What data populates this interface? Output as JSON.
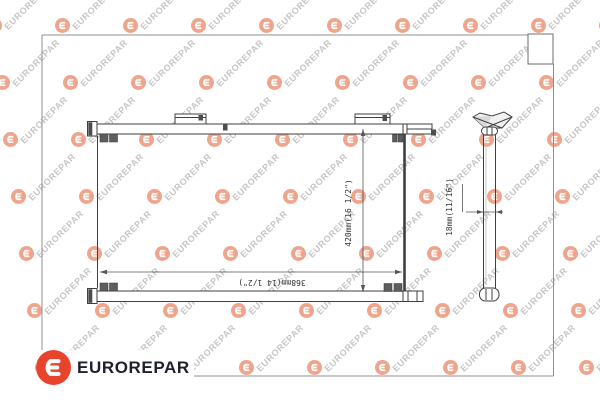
{
  "brand": {
    "name": "EUROREPAR",
    "logo_color": "#e8432c",
    "text_color": "#1e2030"
  },
  "watermark": {
    "text": "EUROREPAR",
    "text_color": "#c6c6c6",
    "logo_color": "#f0a48c"
  },
  "drawing": {
    "line_color": "#3f3f3f",
    "dimensions": {
      "width_label": "368mm(14 1/2\")",
      "height_label": "420mm(16 1/2\")",
      "depth_label": "18mm(11/16\")"
    }
  }
}
